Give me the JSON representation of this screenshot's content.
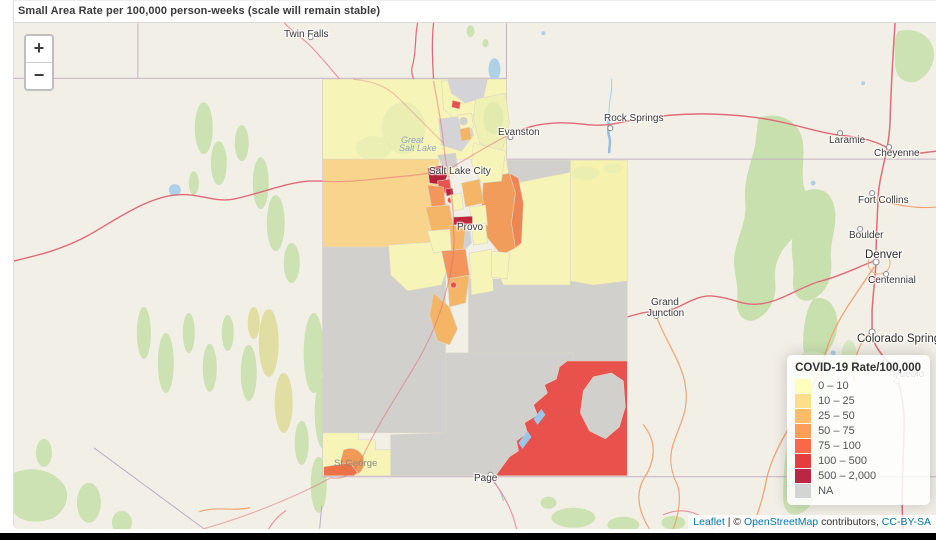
{
  "header": {
    "title": "Small Area Rate per 100,000 person-weeks (scale will remain stable)"
  },
  "map": {
    "zoom_in": "+",
    "zoom_out": "−",
    "labels": [
      {
        "t": "Twin Falls",
        "x": 270,
        "y": 6,
        "c": "city"
      },
      {
        "t": "Evanston",
        "x": 484,
        "y": 104,
        "c": "city"
      },
      {
        "t": "Rock Springs",
        "x": 590,
        "y": 90,
        "c": "city"
      },
      {
        "t": "Laramie",
        "x": 815,
        "y": 112,
        "c": "city"
      },
      {
        "t": "Cheyenne",
        "x": 860,
        "y": 125,
        "c": "city"
      },
      {
        "t": "Fort Collins",
        "x": 844,
        "y": 172,
        "c": "city"
      },
      {
        "t": "Boulder",
        "x": 835,
        "y": 207,
        "c": "city"
      },
      {
        "t": "Denver",
        "x": 851,
        "y": 226,
        "c": "city-lg"
      },
      {
        "t": "Centennial",
        "x": 854,
        "y": 252,
        "c": "city"
      },
      {
        "t": "Colorado Springs",
        "x": 843,
        "y": 310,
        "c": "city-lg"
      },
      {
        "t": "Pueblo",
        "x": 879,
        "y": 346,
        "c": "city"
      },
      {
        "t": "Grand",
        "x": 637,
        "y": 274,
        "c": "city"
      },
      {
        "t": "Junction",
        "x": 633,
        "y": 285,
        "c": "city"
      },
      {
        "t": "Page",
        "x": 460,
        "y": 450,
        "c": "city"
      },
      {
        "t": "Salt Lake City",
        "x": 415,
        "y": 143,
        "c": "city"
      },
      {
        "t": "Provo",
        "x": 443,
        "y": 199,
        "c": "city"
      },
      {
        "t": "St George",
        "x": 320,
        "y": 435,
        "c": "muted"
      },
      {
        "t": "Great",
        "x": 387,
        "y": 112,
        "c": "water"
      },
      {
        "t": "Salt Lake",
        "x": 385,
        "y": 120,
        "c": "water"
      }
    ]
  },
  "legend": {
    "title": "COVID-19 Rate/100,000",
    "items": [
      {
        "label": "0 – 10",
        "color": "#FFFFB2"
      },
      {
        "label": "10 – 25",
        "color": "#FED976"
      },
      {
        "label": "25 – 50",
        "color": "#FEB24C"
      },
      {
        "label": "50 – 75",
        "color": "#FD8D3C"
      },
      {
        "label": "75 – 100",
        "color": "#FC4E2A"
      },
      {
        "label": "100 – 500",
        "color": "#E31A1C"
      },
      {
        "label": "500 – 2,000",
        "color": "#B10026"
      },
      {
        "label": "NA",
        "color": "#CCCCCC"
      }
    ]
  },
  "attribution": {
    "leaflet": "Leaflet",
    "sep1": " | © ",
    "osm": "OpenStreetMap",
    "middle": " contributors, ",
    "license": "CC-BY-SA"
  }
}
